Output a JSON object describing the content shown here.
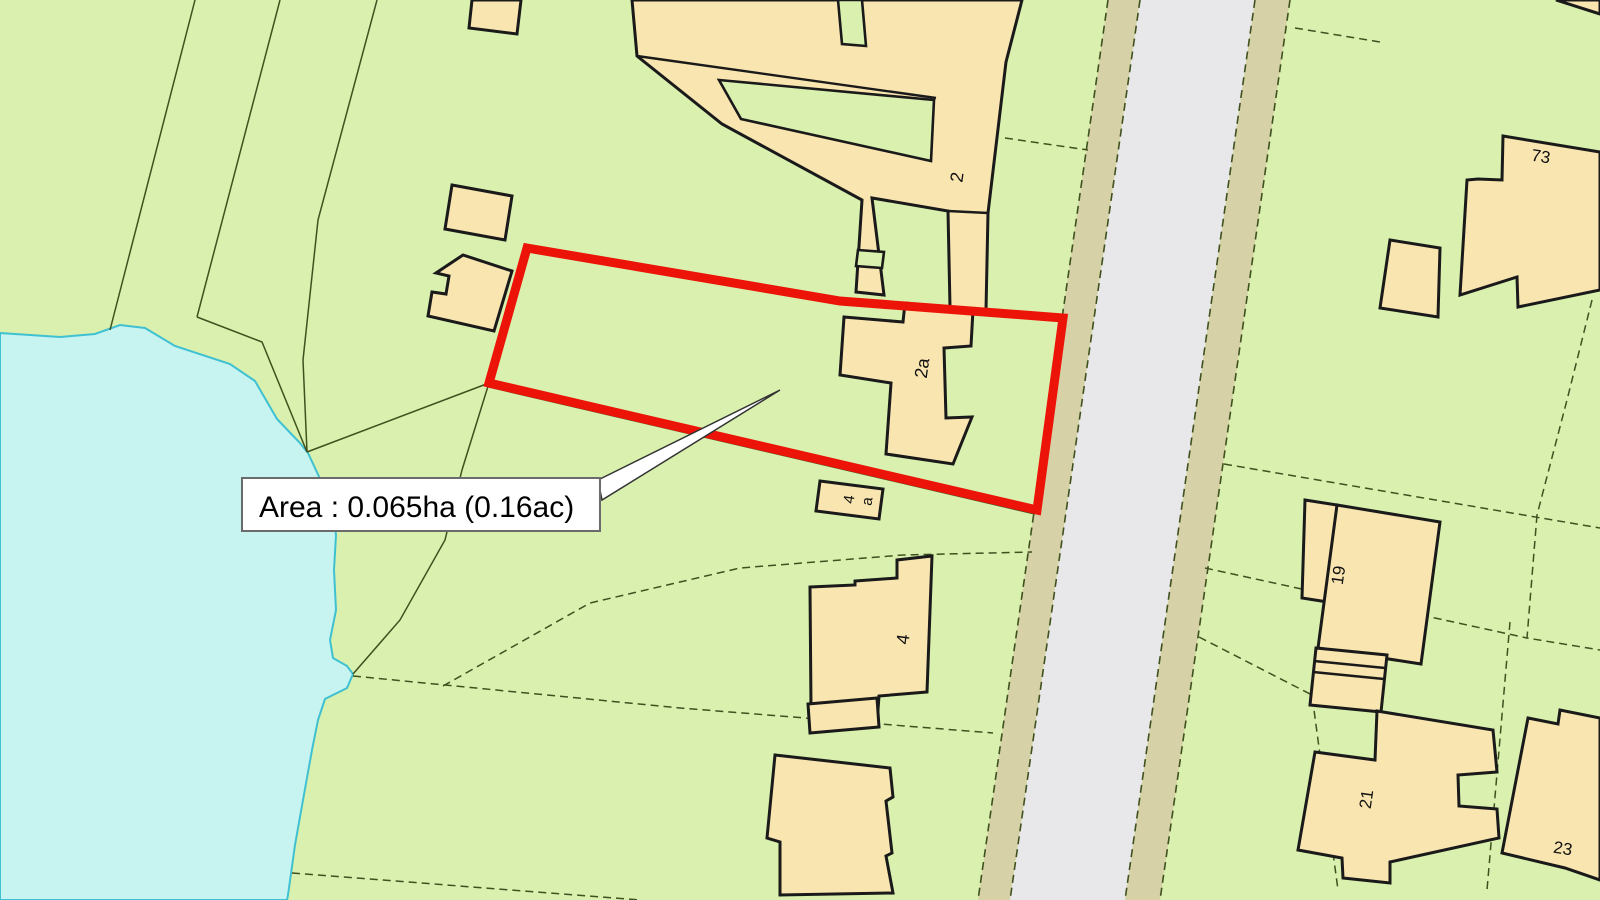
{
  "map": {
    "width": 1600,
    "height": 900,
    "colors": {
      "land_green": "#d9f0ae",
      "water_fill": "#c7f3f1",
      "water_edge": "#3fc1d1",
      "building_fill": "#f8e5b0",
      "building_edge": "#1a1a1a",
      "road_grey": "#e8e8ea",
      "road_verge": "#d6d1a6",
      "parcel_line": "#3f511f",
      "plot_red": "#ec1408",
      "label_box_fill": "#ffffff",
      "label_box_edge": "#6b6b6b",
      "leader_fill": "#ffffff",
      "leader_edge": "#333333"
    },
    "water": [
      [
        0,
        333
      ],
      [
        60,
        337
      ],
      [
        95,
        334
      ],
      [
        120,
        325
      ],
      [
        145,
        328
      ],
      [
        175,
        346
      ],
      [
        230,
        364
      ],
      [
        255,
        381
      ],
      [
        277,
        419
      ],
      [
        300,
        443
      ],
      [
        308,
        453
      ],
      [
        322,
        483
      ],
      [
        332,
        507
      ],
      [
        336,
        535
      ],
      [
        334,
        570
      ],
      [
        336,
        610
      ],
      [
        330,
        640
      ],
      [
        333,
        658
      ],
      [
        347,
        666
      ],
      [
        353,
        674
      ],
      [
        347,
        688
      ],
      [
        325,
        699
      ],
      [
        318,
        720
      ],
      [
        312,
        750
      ],
      [
        303,
        800
      ],
      [
        295,
        845
      ],
      [
        288,
        895
      ],
      [
        287,
        900
      ],
      [
        0,
        900
      ]
    ],
    "road": {
      "verge_left": [
        [
          1108,
          0
        ],
        [
          1140,
          0
        ],
        [
          1010,
          900
        ],
        [
          978,
          900
        ]
      ],
      "carriageway": [
        [
          1140,
          0
        ],
        [
          1255,
          0
        ],
        [
          1125,
          900
        ],
        [
          1010,
          900
        ]
      ],
      "verge_right": [
        [
          1255,
          0
        ],
        [
          1290,
          0
        ],
        [
          1160,
          900
        ],
        [
          1125,
          900
        ]
      ],
      "edge_lines": [
        [
          [
            1108,
            0
          ],
          [
            978,
            900
          ]
        ],
        [
          [
            1140,
            0
          ],
          [
            1010,
            900
          ]
        ],
        [
          [
            1255,
            0
          ],
          [
            1125,
            900
          ]
        ],
        [
          [
            1290,
            0
          ],
          [
            1160,
            900
          ]
        ]
      ]
    },
    "parcel_lines": [
      {
        "dashed": false,
        "pts": [
          [
            195,
            0
          ],
          [
            110,
            330
          ]
        ]
      },
      {
        "dashed": false,
        "pts": [
          [
            280,
            0
          ],
          [
            197,
            317
          ]
        ]
      },
      {
        "dashed": false,
        "pts": [
          [
            197,
            317
          ],
          [
            262,
            342
          ],
          [
            307,
            452
          ]
        ]
      },
      {
        "dashed": false,
        "pts": [
          [
            377,
            0
          ],
          [
            318,
            220
          ],
          [
            303,
            360
          ],
          [
            307,
            452
          ]
        ]
      },
      {
        "dashed": false,
        "pts": [
          [
            307,
            452
          ],
          [
            489,
            383
          ]
        ]
      },
      {
        "dashed": false,
        "pts": [
          [
            489,
            383
          ],
          [
            462,
            470
          ],
          [
            445,
            540
          ],
          [
            400,
            620
          ],
          [
            353,
            674
          ]
        ]
      },
      {
        "dashed": false,
        "pts": [
          [
            489,
            387
          ],
          [
            1035,
            514
          ]
        ]
      },
      {
        "dashed": true,
        "pts": [
          [
            353,
            676
          ],
          [
            680,
            708
          ],
          [
            993,
            733
          ]
        ]
      },
      {
        "dashed": true,
        "pts": [
          [
            443,
            686
          ],
          [
            590,
            603
          ],
          [
            740,
            568
          ],
          [
            903,
            555
          ],
          [
            1032,
            552
          ]
        ]
      },
      {
        "dashed": true,
        "pts": [
          [
            292,
            873
          ],
          [
            640,
            900
          ]
        ]
      },
      {
        "dashed": true,
        "pts": [
          [
            1005,
            138
          ],
          [
            1088,
            150
          ]
        ]
      },
      {
        "dashed": true,
        "pts": [
          [
            1224,
            464
          ],
          [
            1600,
            528
          ]
        ]
      },
      {
        "dashed": true,
        "pts": [
          [
            1592,
            300
          ],
          [
            1567,
            400
          ],
          [
            1537,
            515
          ]
        ]
      },
      {
        "dashed": true,
        "pts": [
          [
            1537,
            515
          ],
          [
            1527,
            638
          ],
          [
            1600,
            650
          ]
        ]
      },
      {
        "dashed": true,
        "pts": [
          [
            1205,
            568
          ],
          [
            1527,
            638
          ]
        ]
      },
      {
        "dashed": true,
        "pts": [
          [
            1199,
            637
          ],
          [
            1312,
            695
          ],
          [
            1338,
            890
          ]
        ]
      },
      {
        "dashed": true,
        "pts": [
          [
            1510,
            622
          ],
          [
            1487,
            890
          ]
        ]
      },
      {
        "dashed": true,
        "pts": [
          [
            1295,
            28
          ],
          [
            1380,
            42
          ]
        ]
      }
    ],
    "buildings": [
      {
        "name": "building-2-complex",
        "pts": [
          [
            632,
            0
          ],
          [
            637,
            56
          ],
          [
            722,
            124
          ],
          [
            862,
            200
          ],
          [
            856,
            292
          ],
          [
            884,
            295
          ],
          [
            872,
            198
          ],
          [
            948,
            211
          ],
          [
            950,
            307
          ],
          [
            986,
            310
          ],
          [
            988,
            213
          ],
          [
            1006,
            62
          ],
          [
            1022,
            0
          ]
        ]
      },
      {
        "name": "building-2a",
        "pts": [
          [
            844,
            317
          ],
          [
            903,
            322
          ],
          [
            905,
            303
          ],
          [
            973,
            310
          ],
          [
            971,
            346
          ],
          [
            944,
            348
          ],
          [
            946,
            418
          ],
          [
            972,
            417
          ],
          [
            953,
            464
          ],
          [
            886,
            454
          ],
          [
            891,
            383
          ],
          [
            840,
            375
          ]
        ]
      },
      {
        "name": "building-4a",
        "pts": [
          [
            820,
            481
          ],
          [
            883,
            489
          ],
          [
            879,
            519
          ],
          [
            816,
            511
          ]
        ]
      },
      {
        "name": "building-4",
        "pts": [
          [
            810,
            587
          ],
          [
            855,
            585
          ],
          [
            855,
            581
          ],
          [
            897,
            578
          ],
          [
            897,
            560
          ],
          [
            932,
            556
          ],
          [
            927,
            692
          ],
          [
            879,
            696
          ],
          [
            878,
            710
          ],
          [
            811,
            708
          ]
        ]
      },
      {
        "name": "building-4-annex",
        "pts": [
          [
            808,
            704
          ],
          [
            877,
            698
          ],
          [
            879,
            727
          ],
          [
            810,
            733
          ]
        ]
      },
      {
        "name": "building-bottom-left",
        "pts": [
          [
            775,
            755
          ],
          [
            890,
            768
          ],
          [
            893,
            797
          ],
          [
            886,
            801
          ],
          [
            892,
            853
          ],
          [
            886,
            856
          ],
          [
            893,
            893
          ],
          [
            780,
            895
          ],
          [
            780,
            842
          ],
          [
            767,
            838
          ]
        ]
      },
      {
        "name": "outbuilding-nw-top",
        "pts": [
          [
            472,
            0
          ],
          [
            521,
            0
          ],
          [
            517,
            34
          ],
          [
            469,
            28
          ]
        ]
      },
      {
        "name": "outbuilding-nw-a",
        "pts": [
          [
            452,
            185
          ],
          [
            512,
            196
          ],
          [
            505,
            240
          ],
          [
            445,
            229
          ]
        ]
      },
      {
        "name": "outbuilding-nw-b",
        "pts": [
          [
            463,
            255
          ],
          [
            512,
            271
          ],
          [
            494,
            331
          ],
          [
            428,
            316
          ],
          [
            432,
            292
          ],
          [
            446,
            294
          ],
          [
            449,
            276
          ],
          [
            436,
            273
          ]
        ]
      },
      {
        "name": "building-73",
        "pts": [
          [
            1503,
            136
          ],
          [
            1600,
            152
          ],
          [
            1600,
            290
          ],
          [
            1518,
            307
          ],
          [
            1517,
            277
          ],
          [
            1460,
            295
          ],
          [
            1467,
            180
          ],
          [
            1478,
            179
          ],
          [
            1502,
            180
          ]
        ]
      },
      {
        "name": "outbuilding-73",
        "pts": [
          [
            1390,
            240
          ],
          [
            1440,
            248
          ],
          [
            1438,
            317
          ],
          [
            1380,
            308
          ]
        ]
      },
      {
        "name": "building-19-wing",
        "pts": [
          [
            1305,
            500
          ],
          [
            1337,
            505
          ],
          [
            1334,
            603
          ],
          [
            1302,
            598
          ]
        ]
      },
      {
        "name": "building-19",
        "pts": [
          [
            1337,
            505
          ],
          [
            1440,
            522
          ],
          [
            1421,
            664
          ],
          [
            1318,
            648
          ]
        ]
      },
      {
        "name": "garage-19",
        "pts": [
          [
            1316,
            648
          ],
          [
            1387,
            655
          ],
          [
            1381,
            712
          ],
          [
            1310,
            705
          ]
        ]
      },
      {
        "name": "building-21",
        "pts": [
          [
            1315,
            752
          ],
          [
            1375,
            760
          ],
          [
            1377,
            711
          ],
          [
            1493,
            730
          ],
          [
            1497,
            772
          ],
          [
            1458,
            775
          ],
          [
            1459,
            806
          ],
          [
            1497,
            809
          ],
          [
            1499,
            838
          ],
          [
            1390,
            862
          ],
          [
            1390,
            883
          ],
          [
            1343,
            878
          ],
          [
            1342,
            858
          ],
          [
            1298,
            850
          ]
        ]
      },
      {
        "name": "building-23",
        "pts": [
          [
            1528,
            718
          ],
          [
            1558,
            724
          ],
          [
            1560,
            710
          ],
          [
            1600,
            718
          ],
          [
            1600,
            880
          ],
          [
            1565,
            868
          ],
          [
            1502,
            853
          ]
        ]
      },
      {
        "name": "corner-verge-ne",
        "pts": [
          [
            1556,
            0
          ],
          [
            1600,
            0
          ],
          [
            1600,
            14
          ]
        ]
      }
    ],
    "green_cutouts": [
      {
        "name": "gap-wedge",
        "pts": [
          [
            719,
            80
          ],
          [
            934,
            100
          ],
          [
            931,
            161
          ],
          [
            741,
            119
          ]
        ]
      },
      {
        "name": "gap-notch-top",
        "pts": [
          [
            838,
            0
          ],
          [
            862,
            0
          ],
          [
            866,
            46
          ],
          [
            842,
            44
          ]
        ]
      },
      {
        "name": "courtyard-foot",
        "pts": [
          [
            858,
            250
          ],
          [
            884,
            252
          ],
          [
            882,
            268
          ],
          [
            856,
            266
          ]
        ]
      }
    ],
    "detail_lines": [
      [
        [
          637,
          56
        ],
        [
          936,
          98
        ]
      ],
      [
        [
          948,
          211
        ],
        [
          988,
          213
        ]
      ],
      [
        [
          1314,
          661
        ],
        [
          1385,
          668
        ]
      ],
      [
        [
          1313,
          672
        ],
        [
          1384,
          679
        ]
      ]
    ],
    "red_plot": [
      [
        527,
        248
      ],
      [
        840,
        301
      ],
      [
        1063,
        318
      ],
      [
        1037,
        510
      ],
      [
        489,
        383
      ]
    ],
    "house_numbers": [
      {
        "text": "2",
        "x": 963,
        "y": 178,
        "rot": -82,
        "size": 18
      },
      {
        "text": "2a",
        "x": 928,
        "y": 369,
        "rot": -82,
        "size": 18
      },
      {
        "text": "4",
        "x": 854,
        "y": 500,
        "rot": -82,
        "size": 15
      },
      {
        "text": "a",
        "x": 872,
        "y": 502,
        "rot": -82,
        "size": 15
      },
      {
        "text": "4",
        "x": 909,
        "y": 640,
        "rot": -82,
        "size": 18
      },
      {
        "text": "73",
        "x": 1540,
        "y": 162,
        "rot": 9,
        "size": 17
      },
      {
        "text": "19",
        "x": 1344,
        "y": 576,
        "rot": -82,
        "size": 17
      },
      {
        "text": "21",
        "x": 1372,
        "y": 800,
        "rot": -82,
        "size": 17
      },
      {
        "text": "23",
        "x": 1562,
        "y": 854,
        "rot": 9,
        "size": 17
      }
    ],
    "area_label": {
      "text": "Area : 0.065ha (0.16ac)",
      "box": {
        "x": "242",
        "y": "478",
        "width": "358",
        "height": "53"
      },
      "text_pos": {
        "x": "259",
        "y": "517"
      },
      "leader_points": "598,480 780,390 602,500"
    }
  }
}
